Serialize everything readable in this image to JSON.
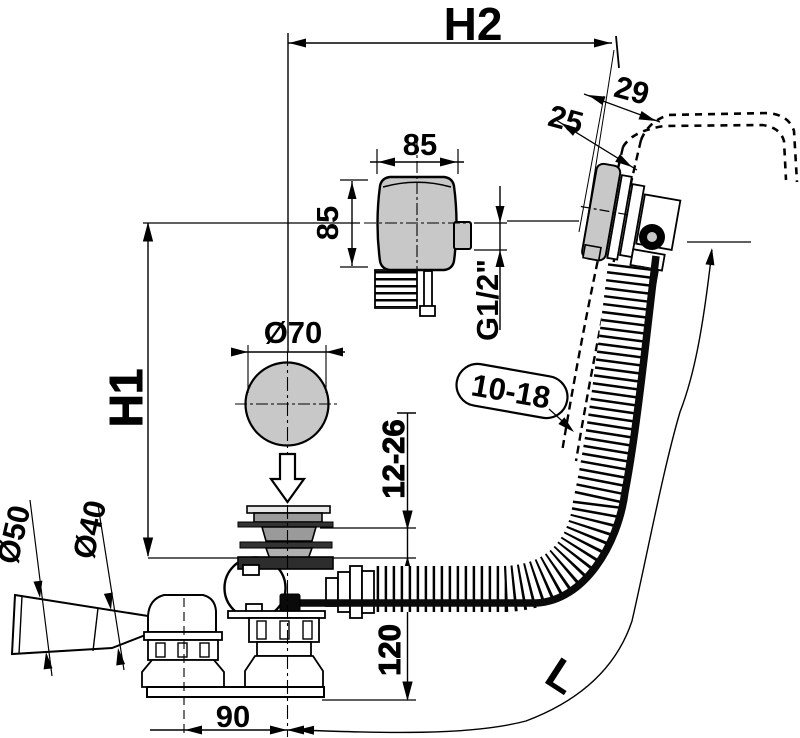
{
  "drawing": {
    "type": "technical-dimension-drawing",
    "subject": "bath waste and overflow set with bowden control, side section",
    "colors": {
      "background": "#ffffff",
      "line": "#000000",
      "metal_gray": "#c8c8c8",
      "mid_gray": "#9a9a9a",
      "dark_gray": "#2d2d2d",
      "cable_black": "#0a0a0a"
    },
    "dimensions": {
      "h2": "H2",
      "h1": "H1",
      "hose_length": "L",
      "head_width": "85",
      "head_depth": "85",
      "plug_diameter": "Ø70",
      "thread_size": "G1/2\"",
      "rim_offset_front": "25",
      "rim_offset_back": "29",
      "panel_thickness": "10-18",
      "bottom_thickness": "12-26",
      "waste_height": "120",
      "outlet_offset": "90",
      "outlet_diameter": "Ø50",
      "outlet_end_diameter": "Ø40"
    }
  }
}
